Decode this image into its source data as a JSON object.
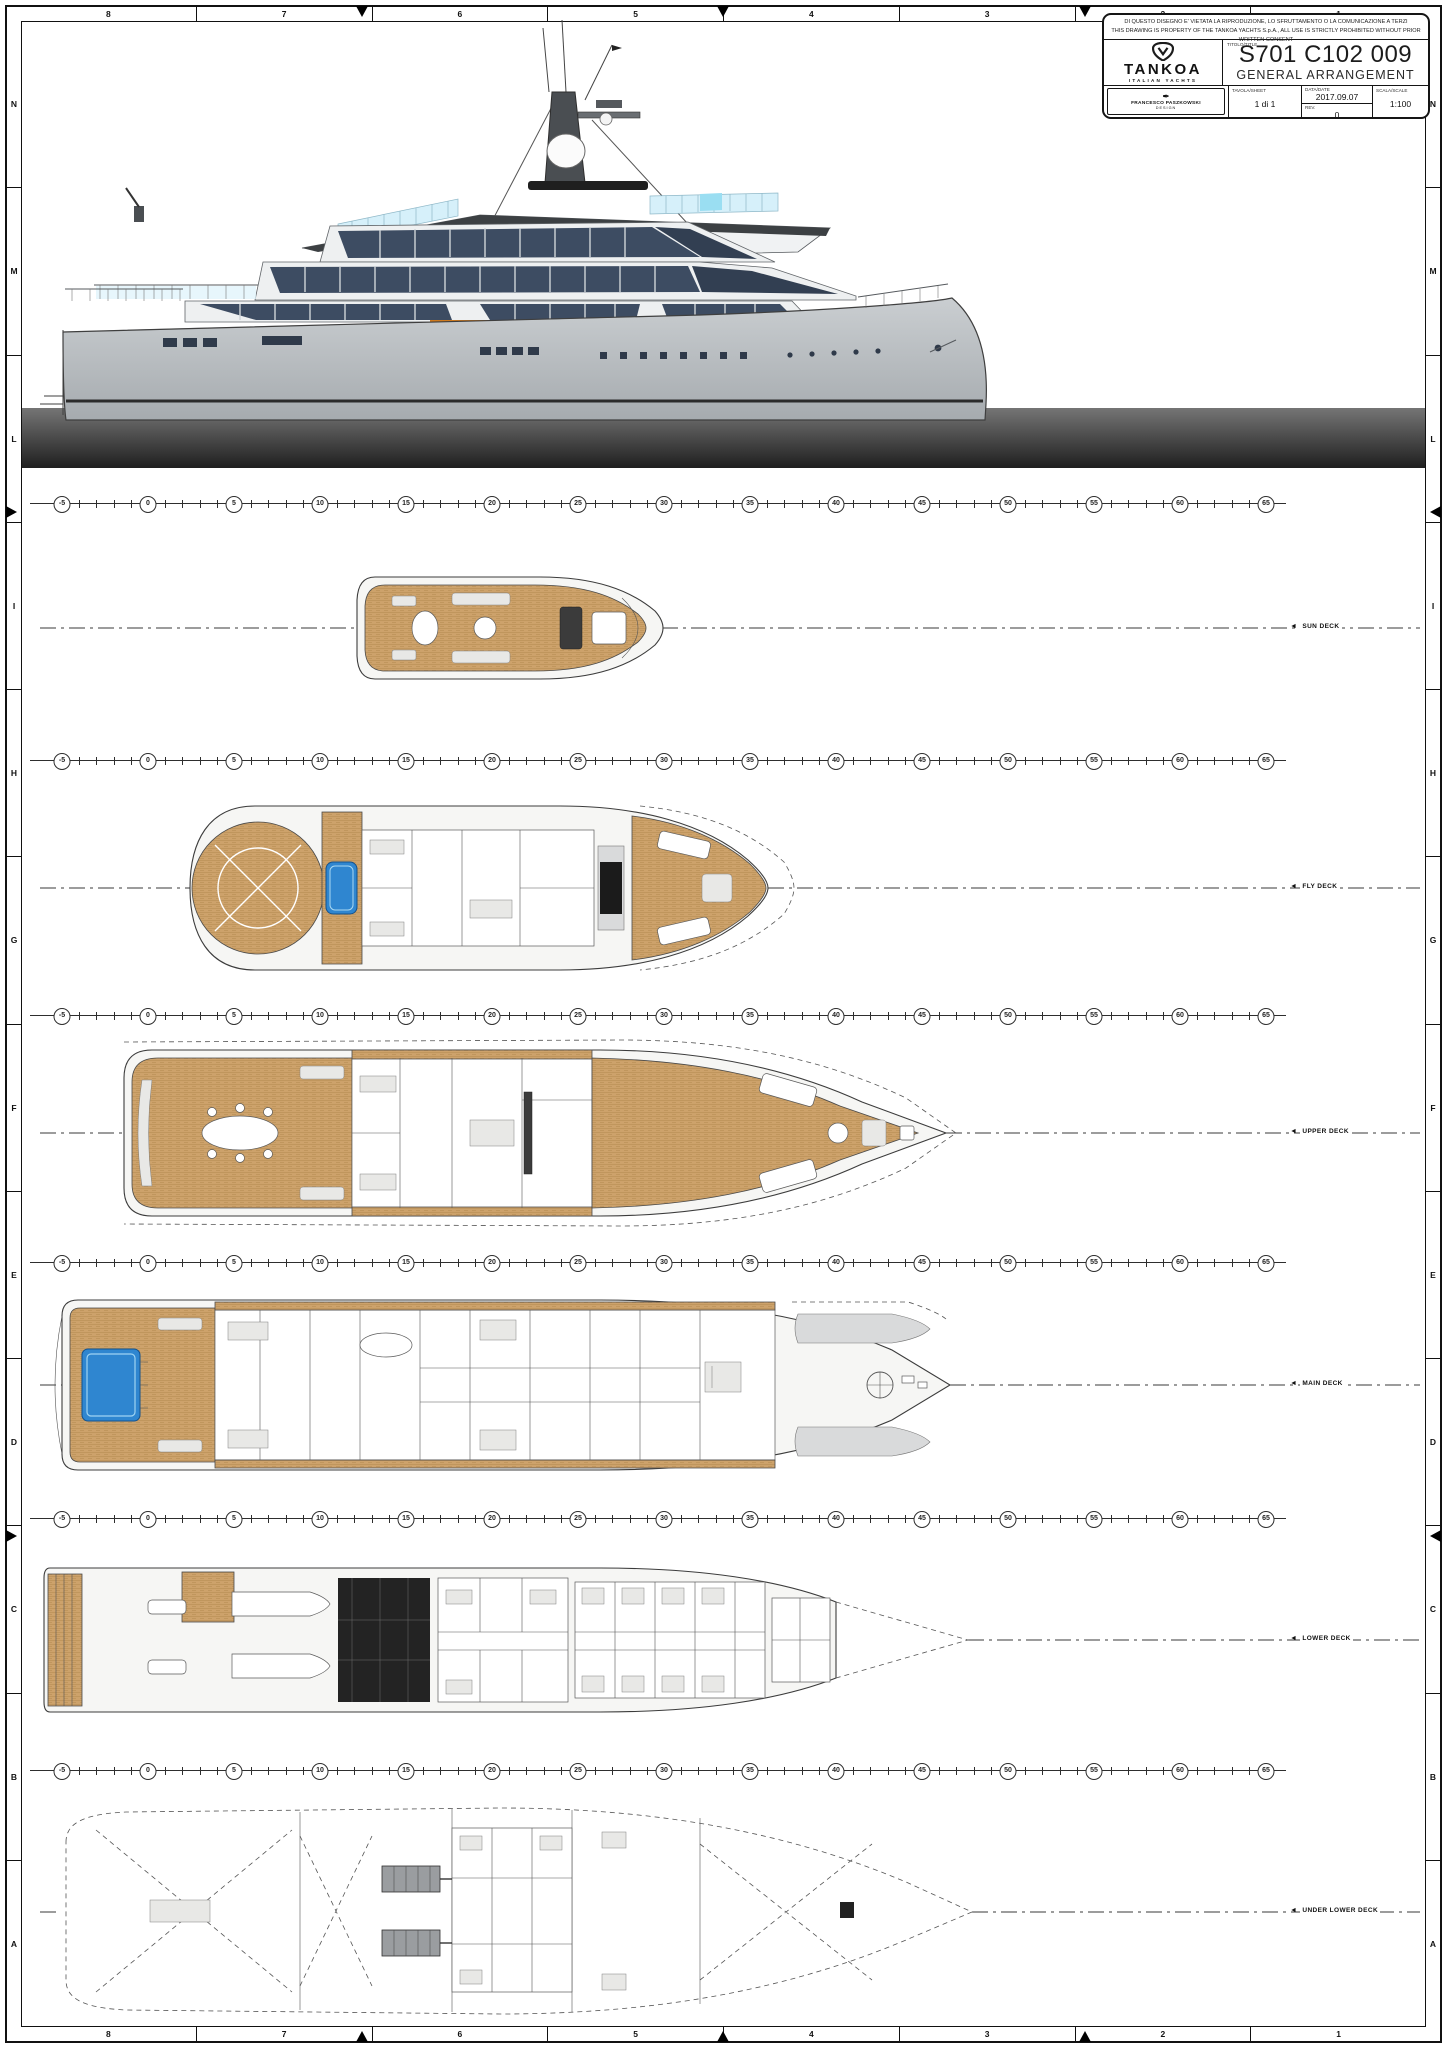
{
  "border": {
    "top_numbers": [
      "8",
      "7",
      "6",
      "5",
      "4",
      "3",
      "2",
      "1"
    ],
    "bottom_numbers": [
      "8",
      "7",
      "6",
      "5",
      "4",
      "3",
      "2",
      "1"
    ],
    "left_letters": [
      "N",
      "M",
      "L",
      "I",
      "H",
      "G",
      "F",
      "E",
      "D",
      "C",
      "B",
      "A"
    ],
    "right_letters": [
      "N",
      "M",
      "L",
      "I",
      "H",
      "G",
      "F",
      "E",
      "D",
      "C",
      "B",
      "A"
    ]
  },
  "title_block": {
    "disclaimer_line1": "DI QUESTO DISEGNO E' VIETATA LA RIPRODUZIONE, LO SFRUTTAMENTO O LA COMUNICAZIONE A TERZI",
    "disclaimer_line2": "THIS DRAWING IS PROPERTY OF THE TANKOA YACHTS S.p.A., ALL USE IS STRICTLY PROHIBITED WITHOUT PRIOR WRITTEN CONSENT",
    "brand": "TANKOA",
    "brand_sub": "ITALIAN YACHTS",
    "title_label": "TITOLO/TITLE",
    "project_code": "S701 C102 009",
    "project_title": "GENERAL ARRANGEMENT",
    "designer": "FRANCESCO PASZKOWSKI",
    "designer_sub": "DESIGN",
    "sheet_label": "TAVOLA/SHEET",
    "sheet_value": "1 di 1",
    "date_label": "DATA/DATE",
    "date_value": "2017.09.07",
    "rev_label": "REV.",
    "rev_value": "0",
    "scale_label": "SCALA/SCALE",
    "scale_value": "1:100"
  },
  "decks": [
    {
      "id": "sun-deck",
      "label": "SUN DECK"
    },
    {
      "id": "fly-deck",
      "label": "FLY DECK"
    },
    {
      "id": "upper-deck",
      "label": "UPPER DECK"
    },
    {
      "id": "main-deck",
      "label": "MAIN DECK"
    },
    {
      "id": "lower-deck",
      "label": "LOWER DECK"
    },
    {
      "id": "under-lower-deck",
      "label": "UNDER LOWER DECK"
    }
  ],
  "stations": {
    "labels": [
      -5,
      0,
      5,
      10,
      15,
      20,
      25,
      30,
      35,
      40,
      45,
      50,
      55,
      60,
      65
    ],
    "minor_step": 1
  },
  "colors": {
    "teak": "#cda26b",
    "window_glass": "#3d4c62",
    "pool_water": "#2f86d0",
    "water_band_top": "#757575",
    "water_band_bottom": "#1f1f1f",
    "accent_orange": "#cf7a1e"
  }
}
